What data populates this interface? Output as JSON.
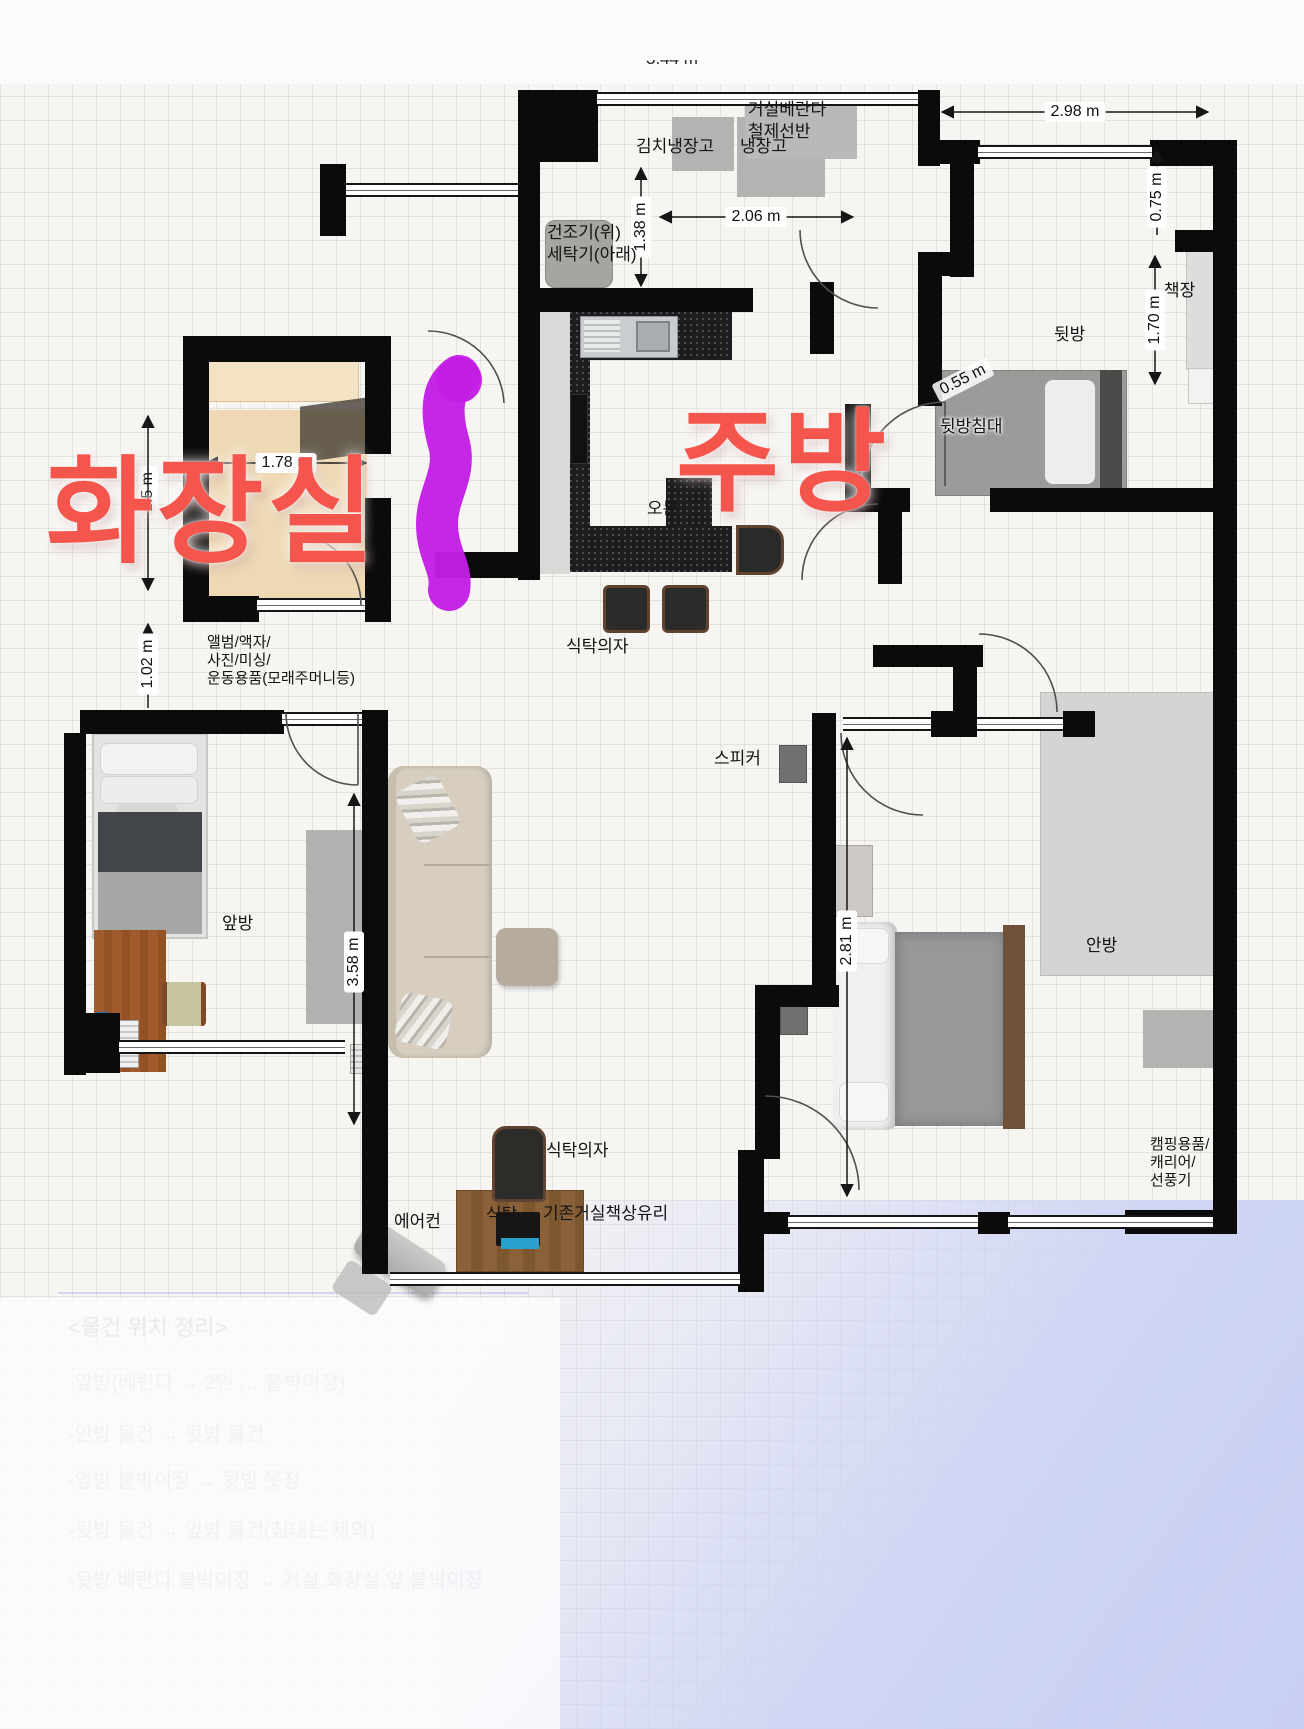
{
  "annotations": {
    "bathroom": "화장실",
    "kitchen": "주방"
  },
  "dimensions": {
    "top_window": "3.44 m",
    "balcony": "2.98 m",
    "fridge_w": "2.06 m",
    "fridge_h": "1.38 m",
    "backroom_top": "0.75 m",
    "backroom_side": "1.70 m",
    "backroom_diag": "0.55 m",
    "bath_w": "1.78 m",
    "bath_h": "1.5 m",
    "closet_h": "1.02 m",
    "living_h": "3.58 m",
    "master_h": "2.81 m"
  },
  "rooms": {
    "back": "뒷방",
    "front": "앞방",
    "master": "안방"
  },
  "labels": {
    "kimchi_fridge": "김치냉장고",
    "fridge": "냉장고",
    "balcony_shelf": [
      "거실베란다",
      "철제선반"
    ],
    "laundry": [
      "건조기(위)",
      "세탁기(아래)"
    ],
    "bookshelf": "책장",
    "back_bed": "뒷방침대",
    "oven": "오븐",
    "dining_chairs": "식탁의자",
    "speaker": "스피커",
    "dining_chair": "식탁의자",
    "aircon": "에어컨",
    "table": "식탁",
    "table_note": "기존거실책상유리",
    "camping": [
      "캠핑용품/",
      "캐리어/",
      "선풍기"
    ],
    "storage": [
      "앨범/액자/",
      "사진/미싱/",
      "운동용품(모래주머니등)"
    ]
  },
  "faded_notes": {
    "heading": "<물건 위치 정리>",
    "items": [
      "-앞방(베란다 → 2인 … 붙박이장)",
      "-안방 물건 → 뒷방 물건",
      "-앞방 붙박이장 → 뒷방 옷장",
      "-뒷방 물건 → 앞방 물건(침대는 제외)",
      "-뒷방 베란다 붙박이장 → 거실 화장실 앞 붙박이장"
    ]
  },
  "colors": {
    "annotation_red": "#f4564d",
    "marker_magenta": "#c41ee6",
    "overlay_lavender": "#c9cff2",
    "wall_black": "#0b0b0b"
  }
}
